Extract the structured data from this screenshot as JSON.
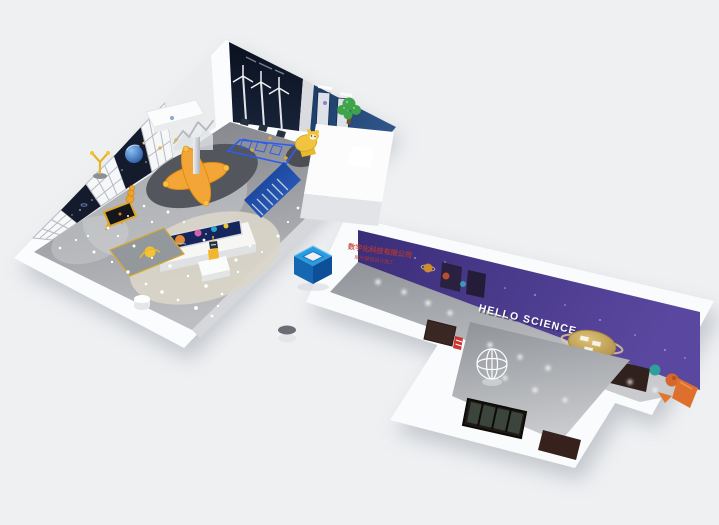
{
  "meta": {
    "description": "Isometric 3D render of a space/science themed children's exhibition hall with an L-shaped corridor"
  },
  "signage": {
    "corridor_wall_text": "HELLO SCIENCE"
  },
  "watermark": {
    "line1": "数字化科技有限公司",
    "line2": "展厅展馆设计施工",
    "color": "#c0392b"
  },
  "logo_cube": {
    "top_color": "#2b9be0",
    "left_color": "#1467b0",
    "right_color": "#0d5098"
  },
  "palette": {
    "background": "#eef0f2",
    "hall_floor_dark": "#808287",
    "hall_floor_light": "#babcc0",
    "corridor_wall_purple": "#4a3a8f",
    "space_wall_navy": "#131b2e",
    "exhibit_blue": "#1d4a8f",
    "accent_orange": "#f2a63c",
    "tree_green": "#3fa24d",
    "gold_planet": "#c2a04e"
  },
  "elements": {
    "hall": [
      "lattice-window-wall",
      "space-poster-wall",
      "planet-mural",
      "mountain-poster",
      "wind-turbine-exhibit",
      "blue-display-wall",
      "tree-sculpture",
      "reception-desk",
      "rocket-star-platform",
      "info-kiosk-screen",
      "blue-sign-board",
      "robot-statue",
      "bear-display-stand",
      "easel-screen",
      "ball-run-platform",
      "spinner-exhibit",
      "coin-sculpture",
      "white-pods",
      "starlight-floor"
    ],
    "corridor": [
      "hello-science-wall",
      "planet-decals",
      "gold-ringed-planet",
      "astronaut-decal",
      "wireframe-globe",
      "ceiling-light-spots",
      "fire-sign",
      "brown-door",
      "wall-screens",
      "orange-slide"
    ],
    "wing": [
      "window-four-pane",
      "brown-door",
      "ceiling-light-spots"
    ],
    "overlays": [
      "logo-cube",
      "red-watermark"
    ]
  }
}
